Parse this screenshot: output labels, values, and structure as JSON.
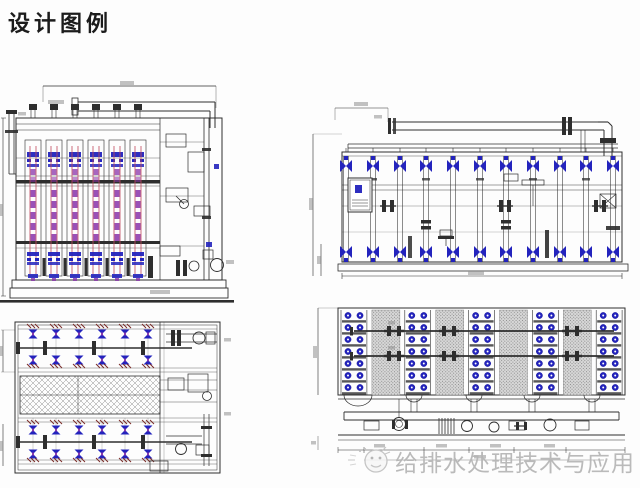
{
  "page": {
    "title": "设计图例"
  },
  "watermark": {
    "text": "给排水处理技术与应用"
  },
  "colors": {
    "line": "#2e2e2e",
    "blue": "#2323bd",
    "blue_dark": "#14149a",
    "purple": "#8833aa",
    "red": "#c0485c",
    "dark_red": "#7a2a26",
    "hatch_gray": "#909090",
    "stipple_bg": "#d8d8d8",
    "stipple_dot": "#8a8a8a",
    "dim_gray": "#8f8f8f",
    "watermark_gray": "#b5b5b5"
  },
  "drawings": [
    {
      "id": "front-elevation",
      "position": "top-left"
    },
    {
      "id": "side-elevation",
      "position": "top-right"
    },
    {
      "id": "plan-view-valve-gallery",
      "position": "bottom-left"
    },
    {
      "id": "plan-view-module-field",
      "position": "bottom-right"
    }
  ]
}
